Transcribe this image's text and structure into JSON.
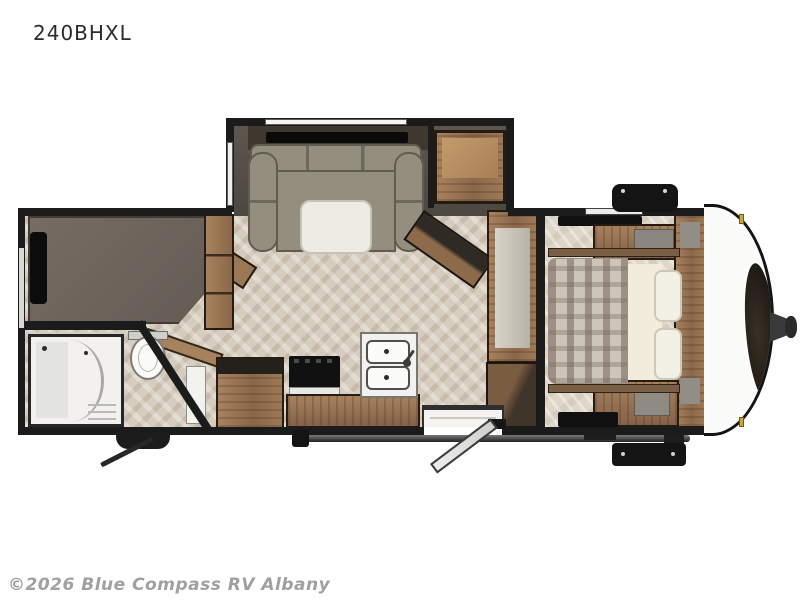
{
  "header": {
    "model_label": "240BHXL"
  },
  "footer": {
    "watermark": "©2026 Blue Compass RV Albany"
  },
  "floorplan": {
    "colors": {
      "wall": "#1b1b1b",
      "floor_main": "#d7cdbe",
      "floor_bedroom": "#ded7c9",
      "slide_interior": "#56504a",
      "wood_cabinet": "#94704e",
      "sofa": "#938e7d",
      "bunk_mattress": "#6f665f",
      "bed_plaid": "#cdc5b7",
      "fixture_white": "#f2f1ee",
      "front_cap": "#fbfbf9",
      "clearance_light_gold": "#c9a53c"
    },
    "fixtures": [
      "slide-out-sofa",
      "tv",
      "slide-cabinet",
      "media-cabinet",
      "bunk-bed",
      "wardrobe",
      "shower",
      "toilet",
      "bathroom-door",
      "refrigerator",
      "range",
      "kitchen-counter",
      "double-sink",
      "pantry",
      "entry-door",
      "entry-steps",
      "awning",
      "queen-bed",
      "pillows",
      "bedroom-cabinets",
      "propane-cover",
      "front-cap",
      "brand-logo",
      "hitch",
      "stabilizer-jack",
      "step-box"
    ]
  }
}
